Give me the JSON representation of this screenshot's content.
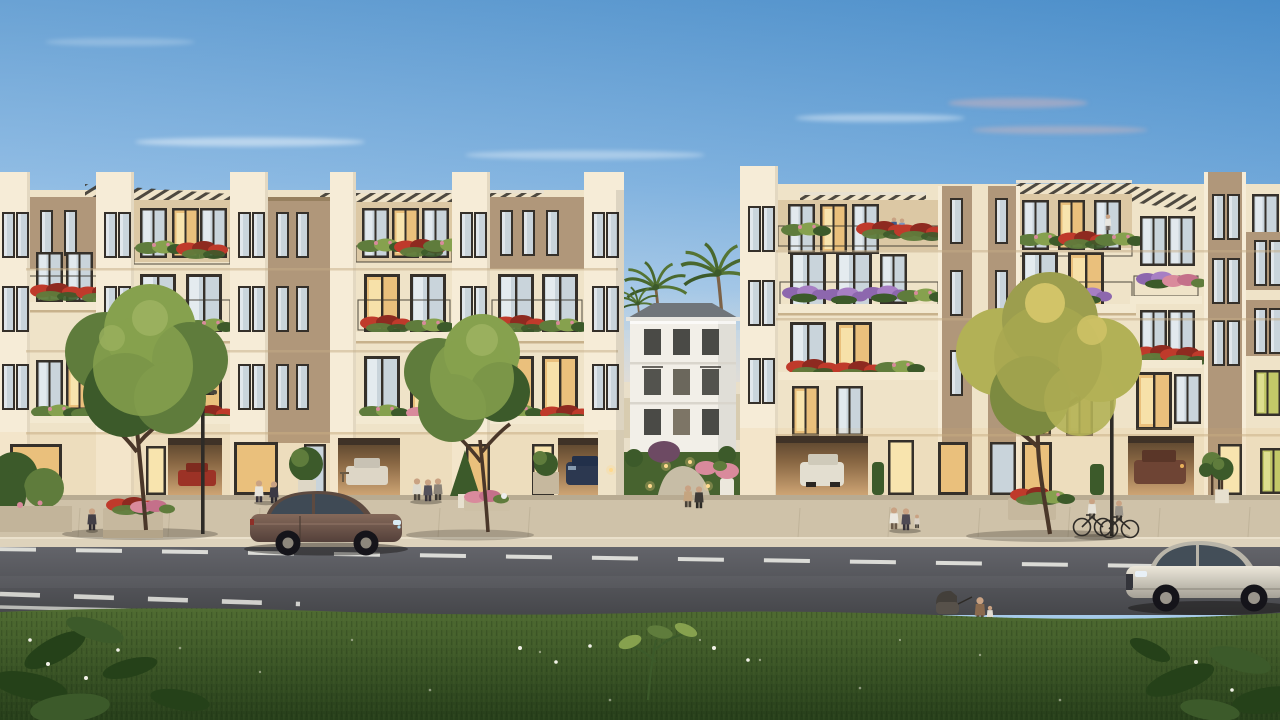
{
  "scene": {
    "type": "3D architectural rendering (exterior visualization)",
    "time_of_day": "dusk / golden hour, clear sky with thin cloud wisps",
    "description": "Photorealistic dusk rendering of a cream-coloured low-rise residential development seen from across the street: two long 4-5 storey apartment blocks with rooftop pergolas, dark-framed windows (some warmly lit), balconies overflowing with red, pink and purple flower boxes, open ground-floor garages with parked cars, a landscaped central courtyard with a white villa and palm trees, street trees, pedestrians, a cyclist pair, a woman pushing a stroller, a brown sedan and a silver sedan on the asphalt road with dashed lane markings, and a dark green lawn with tropical leaves in the foreground. No text or UI elements are present in the image.",
    "buildings": {
      "left_block": "cream facade, 4 storeys plus recessed roof terraces with slatted pergolas, red flower balconies, tan accent panels, ground-floor garages and lit lobbies",
      "right_block": "matching block with red and lavender flower balconies, tan piers, roof pergolas, lit apartments and garage openings",
      "central_villa": "small white 3-storey villa with grey hip roof seen through the landscaped gap between the blocks",
      "courtyard": "curved stone path, lawn, purple shrub, glowing bollard garden lights, white flower vase"
    },
    "vegetation": [
      "two green street trees in front of the left block",
      "one yellow-green street tree in front of the right block",
      "palm trees behind the central villa",
      "topiary and planter boxes along the sidewalk",
      "dark tropical leaves and tiny white flowers in the foreground lawn"
    ],
    "people": [
      "woman walking on left sidewalk",
      "two men talking near left garage",
      "group of three residents mid-left",
      "couple at the courtyard entrance",
      "family of three near right garage",
      "couple on a roof terrace balcony",
      "woman standing on right roof terrace",
      "two cyclists near the right curb",
      "woman pushing a stroller with a small child beside her on the near road edge"
    ],
    "vehicles": {
      "on_road": [
        "brown sedan driving right, left-centre",
        "silver sedan entering frame at lower right"
      ],
      "in_garages": [
        "red car",
        "white car",
        "dark blue car",
        "white car",
        "brown car"
      ]
    },
    "road": {
      "lane_markings": "white dashed centre lines and short solid edge line",
      "surface": "dark grey asphalt"
    }
  },
  "palette": {
    "sky_top": "#4f96d2",
    "sky_mid": "#a6cbea",
    "sky_horizon": "#f2dcc6",
    "cloud_white": "#ffffff",
    "cloud_mauve": "#c7b0bd",
    "facade_cream": "#efe3c8",
    "facade_light": "#f6ecd7",
    "facade_shadow": "#e3d0ae",
    "panel_tan": "#b0977a",
    "panel_tan_dark": "#97805f",
    "terrace_wall": "#dcc8a4",
    "window_frame": "#35302a",
    "glass_day": "#c9d4db",
    "glass_day_bright": "#e9eef2",
    "glass_lit": "#eac07c",
    "glass_lit_bright": "#f8e4ae",
    "glass_green": "#c2c868",
    "pergola_dark": "#3d3931",
    "pergola_beam": "#e8e1d1",
    "railing": "#3a352c",
    "slab_cream": "#f3e9d1",
    "slab_shadow": "#c8b28c",
    "flower_red": "#bf3a2b",
    "flower_red_dark": "#8e2a20",
    "flower_pink": "#d98a9c",
    "flower_purple": "#8d67ae",
    "foliage": "#5f7c3c",
    "foliage_dark": "#3c5a2a",
    "foliage_light": "#86a14e",
    "foliage_yellow": "#b2b156",
    "trunk": "#4a3729",
    "white_building": "#f2efe8",
    "roof_gray": "#70757a",
    "sidewalk": "#cfc2a9",
    "curb": "#ded3bc",
    "road": "#55565b",
    "road_dark": "#47484c",
    "lane_white": "#e9e9e3",
    "grass": "#4e6a31",
    "grass_dark": "#2c461f",
    "leaf_dark": "#254119",
    "garage_glow": "#c89e6e",
    "garage_dark": "#5e4730",
    "car_brown": "#705647",
    "car_silver": "#d6d2c5",
    "metal_dark": "#2e2b27",
    "light_warm": "#ffd98d",
    "skin": "#c9a283"
  }
}
